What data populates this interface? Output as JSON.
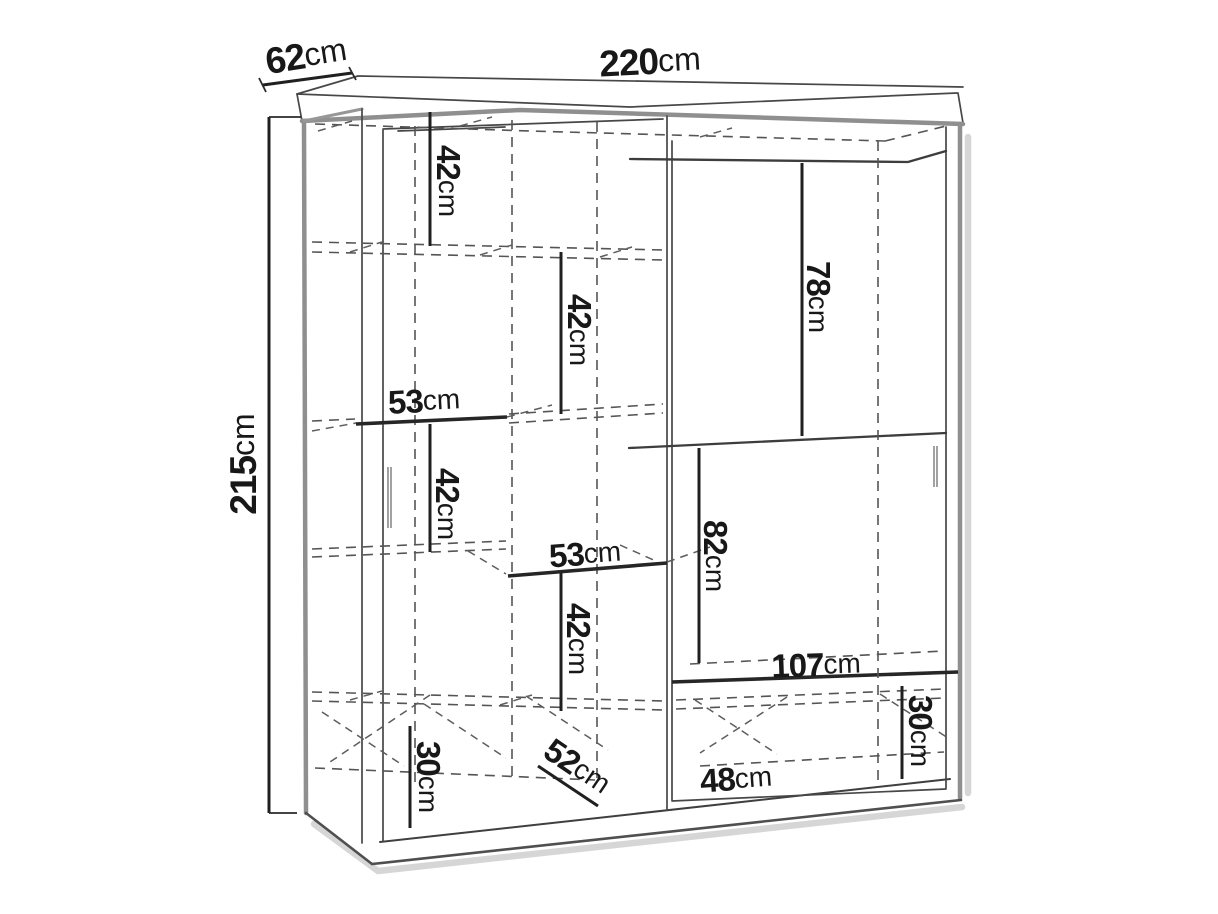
{
  "diagram": {
    "kind": "wardrobe-technical-drawing",
    "colors": {
      "background": "#ffffff",
      "line": "#474747",
      "thick_edge": "#8f8f8f",
      "dimension": "#202020",
      "text": "#181818",
      "shadow": "#cfcfcf"
    },
    "dims": {
      "width": {
        "num": "220",
        "unit": "cm"
      },
      "depth": {
        "num": "62",
        "unit": "cm"
      },
      "height": {
        "num": "215",
        "unit": "cm"
      },
      "top_shelf": {
        "num": "42",
        "unit": "cm"
      },
      "second_shelf": {
        "num": "42",
        "unit": "cm"
      },
      "shelf_width_upper": {
        "num": "53",
        "unit": "cm"
      },
      "third_shelf": {
        "num": "42",
        "unit": "cm"
      },
      "shelf_width_lower": {
        "num": "53",
        "unit": "cm"
      },
      "fourth_shelf": {
        "num": "42",
        "unit": "cm"
      },
      "door_top_panel": {
        "num": "78",
        "unit": "cm"
      },
      "door_mid_panel": {
        "num": "82",
        "unit": "cm"
      },
      "right_shelf_width": {
        "num": "107",
        "unit": "cm"
      },
      "base_left": {
        "num": "30",
        "unit": "cm"
      },
      "base_right": {
        "num": "30",
        "unit": "cm"
      },
      "interior_depth": {
        "num": "52",
        "unit": "cm"
      },
      "bottom_width": {
        "num": "48",
        "unit": "cm"
      }
    }
  }
}
